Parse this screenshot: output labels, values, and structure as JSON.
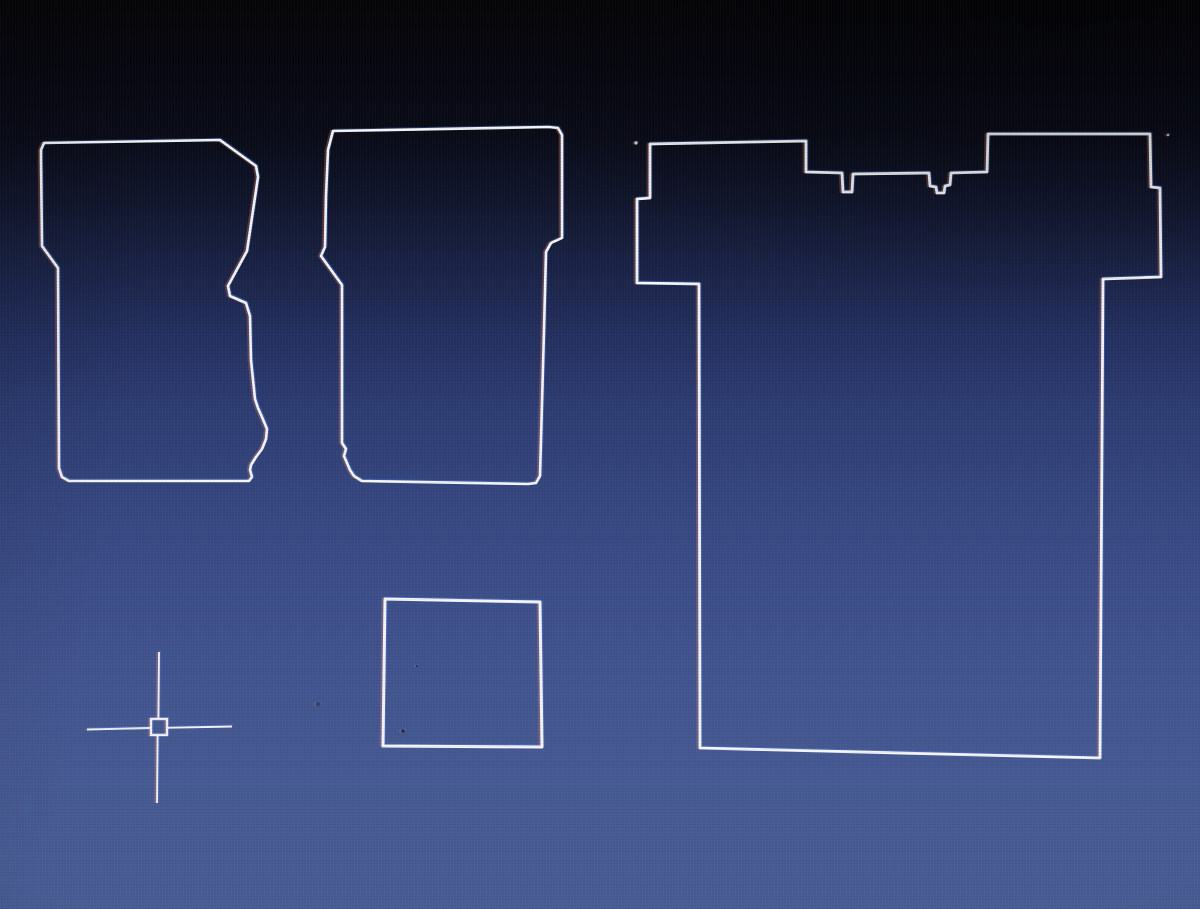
{
  "canvas": {
    "width": 1200,
    "height": 909,
    "description_colors": {
      "background_top": "#050507",
      "background_bottom": "#495d95",
      "line_color": "#f2f5fa",
      "cursor_color": "#eef1f7",
      "fringe_warm": "#ff8250",
      "fringe_cool": "#5a8cff"
    },
    "line_color": "#f2f5fa",
    "shapes": [
      {
        "name": "left-mat-outline",
        "type": "closed-polyline",
        "stroke_width": 2.6,
        "points": [
          [
            41,
            150
          ],
          [
            44,
            143
          ],
          [
            220,
            140
          ],
          [
            256,
            166
          ],
          [
            258,
            177
          ],
          [
            247,
            251
          ],
          [
            228,
            286
          ],
          [
            230,
            296
          ],
          [
            246,
            303
          ],
          [
            250,
            316
          ],
          [
            251,
            360
          ],
          [
            255,
            399
          ],
          [
            258,
            408
          ],
          [
            262,
            417
          ],
          [
            267,
            429
          ],
          [
            266,
            439
          ],
          [
            262,
            449
          ],
          [
            256,
            457
          ],
          [
            251,
            465
          ],
          [
            250,
            470
          ],
          [
            252,
            477
          ],
          [
            249,
            481
          ],
          [
            69,
            481
          ],
          [
            62,
            477
          ],
          [
            59,
            468
          ],
          [
            58,
            268
          ],
          [
            42,
            246
          ],
          [
            41,
            160
          ]
        ]
      },
      {
        "name": "middle-mat-outline",
        "type": "closed-polyline",
        "stroke_width": 2.6,
        "points": [
          [
            333,
            131
          ],
          [
            549,
            127
          ],
          [
            558,
            128
          ],
          [
            562,
            135
          ],
          [
            562,
            238
          ],
          [
            551,
            243
          ],
          [
            546,
            252
          ],
          [
            544,
            330
          ],
          [
            540,
            476
          ],
          [
            536,
            483
          ],
          [
            528,
            484
          ],
          [
            362,
            481
          ],
          [
            354,
            476
          ],
          [
            350,
            470
          ],
          [
            347,
            463
          ],
          [
            344,
            456
          ],
          [
            346,
            449
          ],
          [
            342,
            443
          ],
          [
            342,
            285
          ],
          [
            321,
            256
          ],
          [
            325,
            247
          ],
          [
            326,
            196
          ],
          [
            328,
            150
          ]
        ]
      },
      {
        "name": "right-mat-outline",
        "type": "closed-polyline",
        "stroke_width": 2.8,
        "points": [
          [
            650,
            144
          ],
          [
            806,
            141
          ],
          [
            806,
            172
          ],
          [
            842,
            173
          ],
          [
            843,
            192
          ],
          [
            852,
            192
          ],
          [
            853,
            174
          ],
          [
            929,
            173
          ],
          [
            930,
            186
          ],
          [
            936,
            187
          ],
          [
            937,
            193
          ],
          [
            944,
            193
          ],
          [
            945,
            186
          ],
          [
            950,
            185
          ],
          [
            951,
            173
          ],
          [
            987,
            172
          ],
          [
            988,
            134
          ],
          [
            1150,
            134
          ],
          [
            1151,
            187
          ],
          [
            1160,
            188
          ],
          [
            1161,
            277
          ],
          [
            1103,
            279
          ],
          [
            1100,
            758
          ],
          [
            700,
            748
          ],
          [
            699,
            284
          ],
          [
            637,
            283
          ],
          [
            637,
            199
          ],
          [
            650,
            198
          ]
        ]
      },
      {
        "name": "small-square-outline",
        "type": "closed-polyline",
        "stroke_width": 3.0,
        "points": [
          [
            385,
            599
          ],
          [
            540,
            602
          ],
          [
            542,
            747
          ],
          [
            383,
            746
          ]
        ]
      }
    ],
    "specks": [
      {
        "name": "stray-dot-left",
        "x": 636,
        "y": 143,
        "r": 1.6,
        "color": "#dfe5ef",
        "opacity": 0.9
      },
      {
        "name": "stray-dot-right",
        "x": 1168,
        "y": 135,
        "r": 1.3,
        "color": "#cdd5e4",
        "opacity": 0.85
      },
      {
        "name": "dust-speck-in-square",
        "x": 403,
        "y": 731,
        "r": 1.7,
        "color": "#141b30",
        "opacity": 0.8
      },
      {
        "name": "dust-speck-mid",
        "x": 417,
        "y": 666,
        "r": 1.1,
        "color": "#1c2541",
        "opacity": 0.7
      },
      {
        "name": "dust-smudge-left-of-square",
        "x": 318,
        "y": 704,
        "r": 2.2,
        "color": "#222b49",
        "opacity": 0.6
      }
    ],
    "cursor": {
      "name": "crosshair-cursor",
      "center": [
        159,
        727
      ],
      "color": "#eef1f7",
      "stroke_width": 1.9,
      "segments": [
        {
          "name": "crosshair-v-top",
          "x1": 159,
          "y1": 652,
          "x2": 158.4,
          "y2": 719
        },
        {
          "name": "crosshair-v-bottom",
          "x1": 157.6,
          "y1": 735,
          "x2": 157,
          "y2": 803
        },
        {
          "name": "crosshair-h-left",
          "x1": 87,
          "y1": 729.5,
          "x2": 151,
          "y2": 728
        },
        {
          "name": "crosshair-h-right",
          "x1": 167,
          "y1": 727.8,
          "x2": 232,
          "y2": 726.5
        }
      ],
      "pickbox": {
        "x": 151,
        "y": 719,
        "width": 16,
        "height": 16,
        "stroke_width": 2.4
      }
    }
  }
}
